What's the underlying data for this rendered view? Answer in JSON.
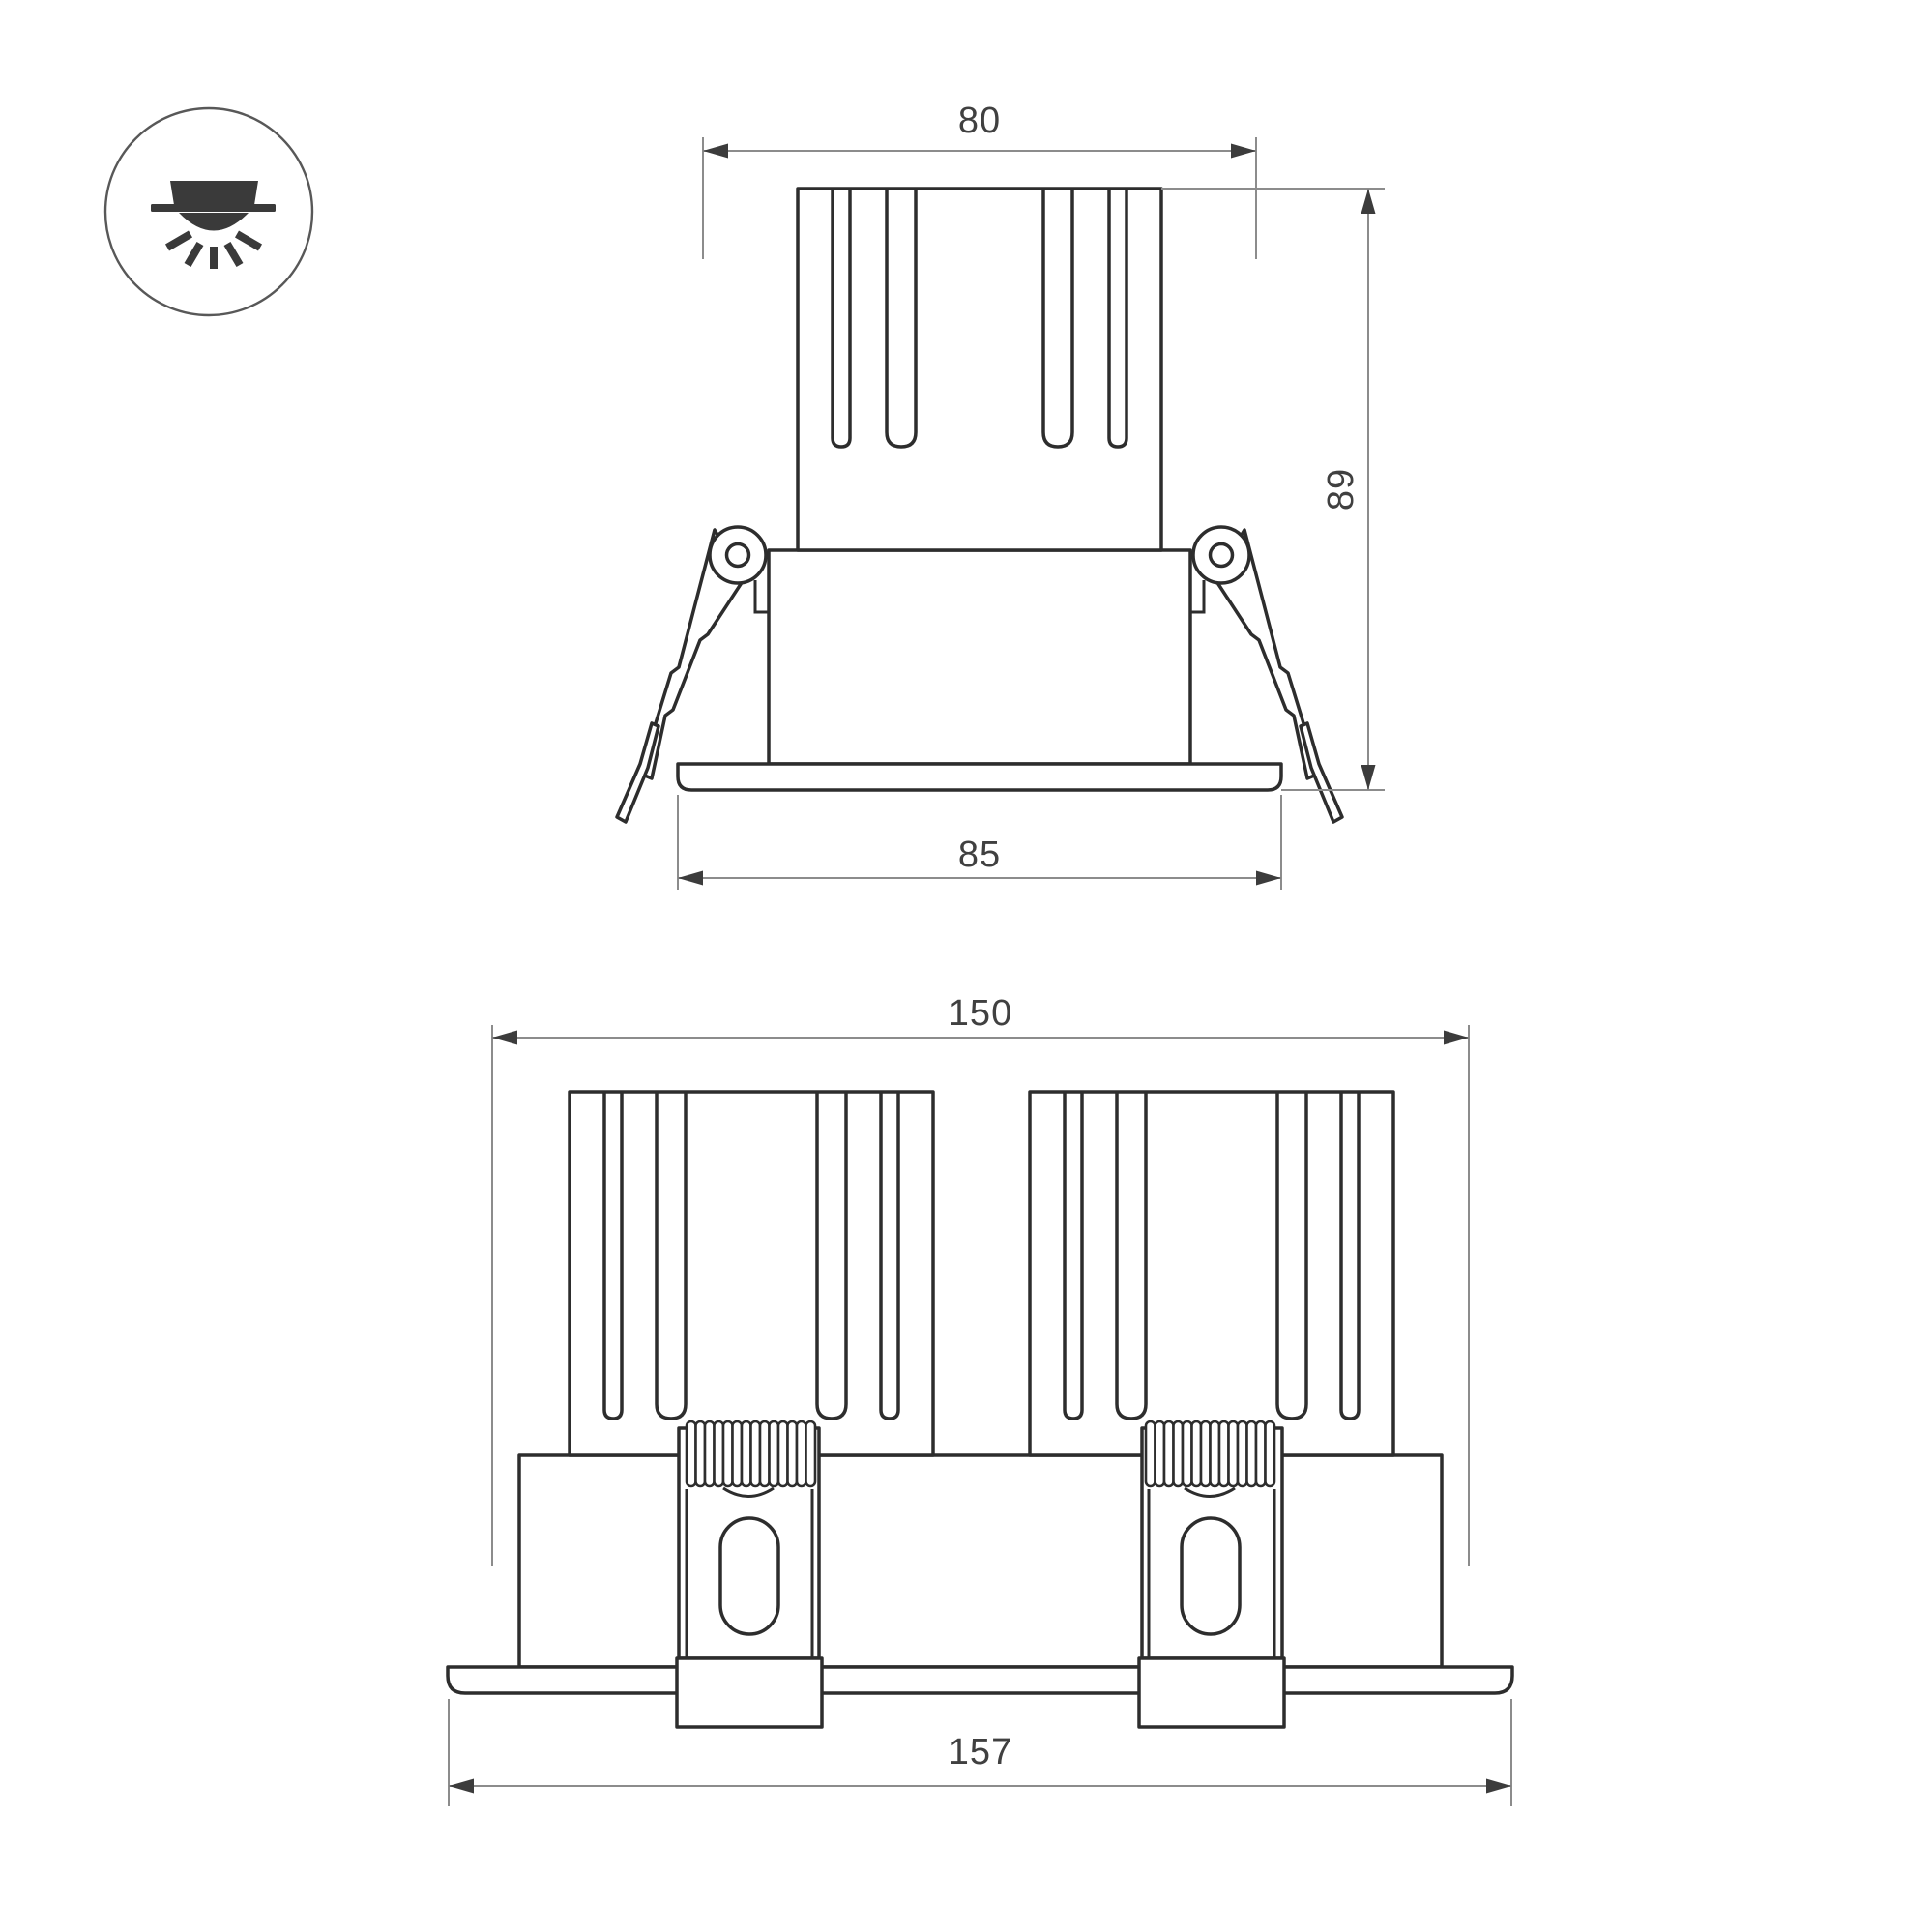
{
  "page": {
    "background": "#ffffff"
  },
  "colors": {
    "line": "#2d2d2d",
    "dimension_line": "#8c8c8c",
    "arrow": "#3c3c3c",
    "text": "#404040"
  },
  "icon": {
    "name": "recessed-downlight"
  },
  "views": {
    "side": {
      "name": "single-module-side-view",
      "dims": {
        "top_width": "80",
        "height": "89",
        "flange_width": "85"
      }
    },
    "front": {
      "name": "dual-module-front-view",
      "dims": {
        "body_width": "150",
        "flange_width": "157"
      }
    }
  }
}
